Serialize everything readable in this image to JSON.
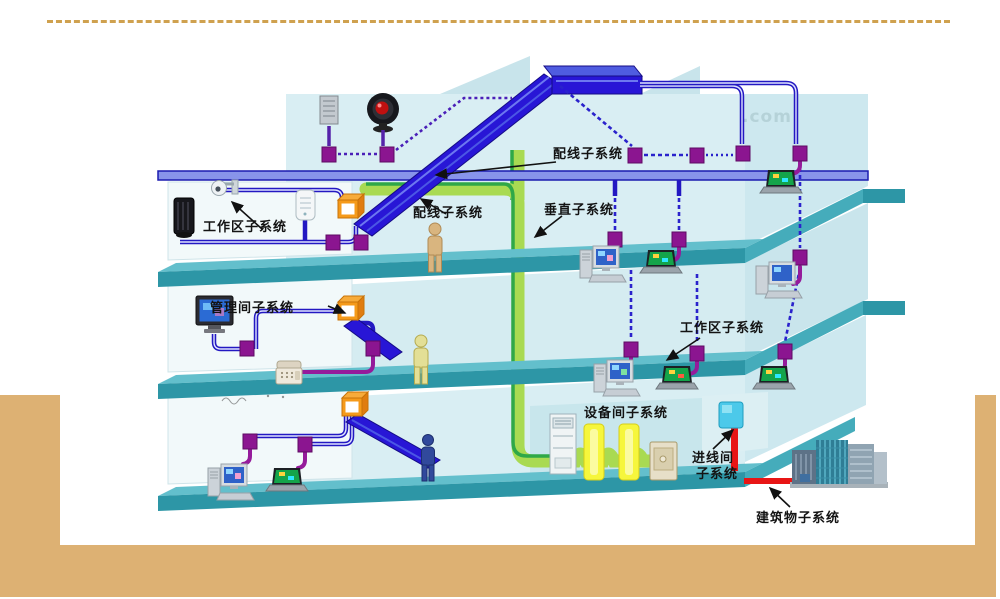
{
  "slide": {
    "background_color": "#ffffff",
    "accent_bar_color": "#ddb173",
    "dashed_rule_color": "#cfa14f"
  },
  "diagram": {
    "subject": "structured cabling system building cutaway",
    "watermark": ".com",
    "labels": {
      "peixian_top": "配线子系统",
      "peixian_mid": "配线子系统",
      "chuizhi": "垂直子系统",
      "gongzuoqu_left": "工作区子系统",
      "gongzuoqu_right": "工作区子系统",
      "guanlijian": "管理间子系统",
      "shebeijian": "设备间子系统",
      "jinxian_line1": "进线间",
      "jinxian_line2": "子系统",
      "jianzhuwu": "建筑物子系统"
    },
    "colors": {
      "floor_slab_top": "#63bfcc",
      "floor_slab_front": "#2d96a6",
      "floor_slab_side": "#45acbb",
      "wall_light": "#d9eef3",
      "wall_wing": "#cde8ef",
      "room_wall": "#f2f9fa",
      "backbone_blue": "#2816d6",
      "thin_line_blue": "#8894ea",
      "device_cable_purple": "#951b9b",
      "outlet_purple": "#8b1590",
      "riser_green_light": "#a9da52",
      "riser_green_dark": "#2fa848",
      "junction_box_orange": "#f59a1a",
      "entrance_cable_red": "#e81515",
      "entrance_box_cyan": "#4cc9ea",
      "equipment_rack_yellow": "#f6f63c"
    }
  }
}
